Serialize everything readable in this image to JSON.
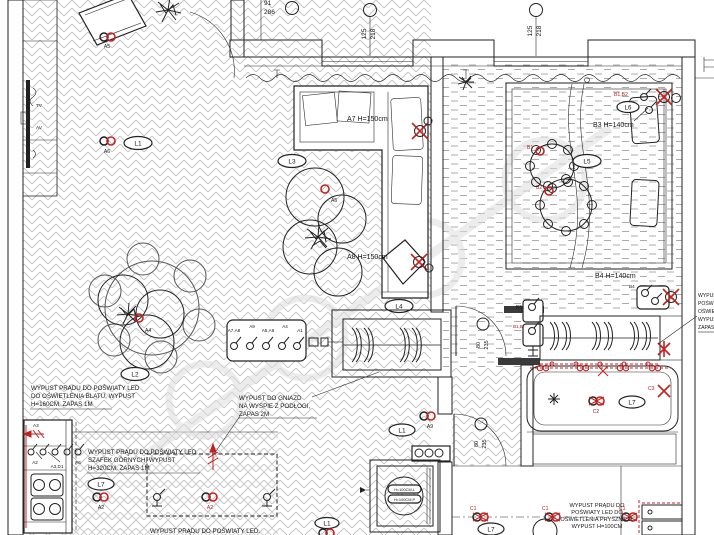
{
  "dims": {
    "tl_w": "91",
    "tl_h": "286",
    "win1_w": "125",
    "win1_h": "218",
    "win2_w": "125",
    "win2_h": "218",
    "bed_door_w": "80",
    "bed_door_h": "235",
    "bath_door_w": "80",
    "bath_door_h": "235"
  },
  "media": {
    "tv": "TV",
    "av": "AV"
  },
  "lights": {
    "l1_living": "L1",
    "l1_hall": "L1",
    "l1_hall2": "L1",
    "l2": "L2",
    "l3": "L3",
    "l4": "L4",
    "l5": "L5",
    "l6": "L6",
    "l7_kitchen": "L7",
    "l7_bath": "L7",
    "l7_shower": "L7"
  },
  "outlets": {
    "a2_kitchen": "A2",
    "a2_island": "A2",
    "a3": "A3",
    "a3_d1": "A3,D1",
    "a4": "A4",
    "a5": "A5",
    "a6_living": "A6",
    "a6_sofa": "A6",
    "a7_note": "A7 H=150cm",
    "a8_note": "A8 H=150cm",
    "a9": "A9",
    "b1": "B1",
    "b2": "B2",
    "b1b2_top": "B1,B2",
    "b1b2_door": "B1,B2",
    "b3_note": "B3 H=140cm",
    "b4_note": "B4 H=140cm",
    "b4": "B4",
    "b5": "B5",
    "c1_a": "C1",
    "c1_b": "C1",
    "c1_c": "C1",
    "c2": "C2",
    "c3": "C3"
  },
  "panel": {
    "s1": "A7,A8",
    "s2": "A9",
    "s3": "A5,A6",
    "s4": "A4",
    "s5": "A1"
  },
  "washer": {
    "tag1": "H=100CM,L",
    "tag2": "H=100CM,P"
  },
  "notes": {
    "counter": [
      "WYPUST PRĄDU DO POŚWIATY LED",
      "DO OŚWIETLENIA BLATU, WYPUST",
      "H=160CM, ZAPAS 1M"
    ],
    "cabinets": [
      "WYPUST PRĄDU DO POŚWIATY LED",
      "SZAFEK GÓRNYCH, WYPUST",
      "H=320CM, ZAPAS 1M"
    ],
    "island": [
      "WYPUST DO GNIAZD",
      "NA WYSPIE Z PODŁOGI,",
      "ZAPAS 2M"
    ],
    "bottom": "WYPUST PRĄDU DO POŚWIATY LED.",
    "shower": [
      "WYPUST PRĄDU DO",
      "POŚWIATY LED DO",
      "OŚWIETLENIA PRYSZNICU,",
      "WYPUST H=100CM"
    ],
    "clipped": [
      "WYPUST",
      "POŚWIATY",
      "OŚWIETLENIA",
      "WYPUST",
      "ZAPAS"
    ]
  }
}
